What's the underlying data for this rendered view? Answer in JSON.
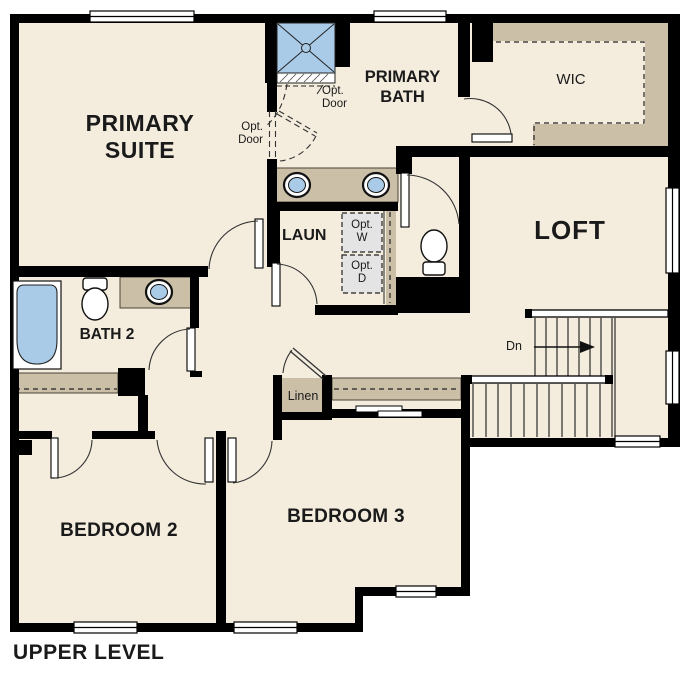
{
  "plan_title": "UPPER LEVEL",
  "colors": {
    "floor": "#f4edde",
    "wall": "#000000",
    "casework_tan": "#cbc0a7",
    "fixture_blue": "#a9cbe8",
    "optional_box_gray": "#e4e4e4"
  },
  "rooms": {
    "primary_suite": "PRIMARY\nSUITE",
    "primary_bath": "PRIMARY\nBATH",
    "wic": "WIC",
    "loft": "LOFT",
    "laundry": "LAUN",
    "bath2": "BATH 2",
    "bedroom2": "BEDROOM 2",
    "bedroom3": "BEDROOM 3",
    "linen": "Linen"
  },
  "annotations": {
    "opt_door_left": "Opt.\nDoor",
    "opt_door_right": "Opt.\nDoor",
    "opt_washer": "Opt.\nW",
    "opt_dryer": "Opt.\nD",
    "stairs_down": "Dn"
  }
}
